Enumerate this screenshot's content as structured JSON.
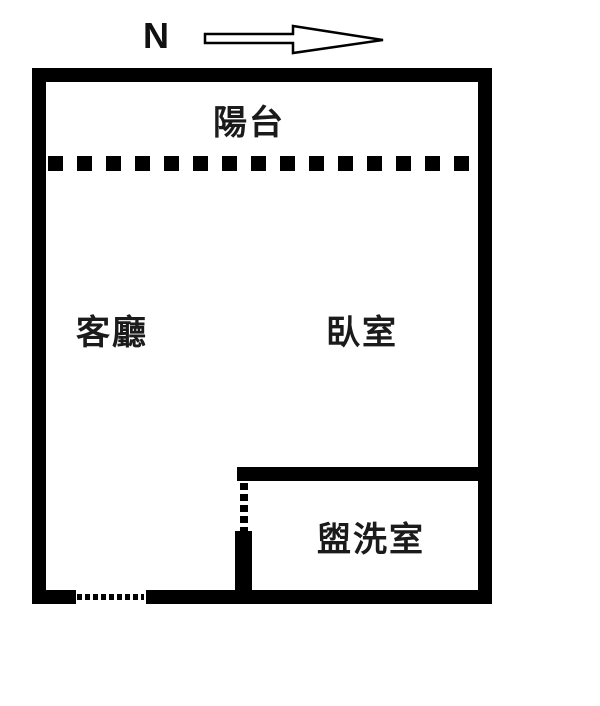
{
  "compass": {
    "north_label": "N",
    "arrow_direction": "right"
  },
  "plan": {
    "rooms": [
      {
        "id": "balcony",
        "label": "陽台"
      },
      {
        "id": "living-room",
        "label": "客廳"
      },
      {
        "id": "bedroom",
        "label": "臥室"
      },
      {
        "id": "washroom",
        "label": "盥洗室"
      }
    ]
  },
  "colors": {
    "wall": "#000000",
    "background": "#ffffff",
    "label_text": "#1b1b1b"
  }
}
